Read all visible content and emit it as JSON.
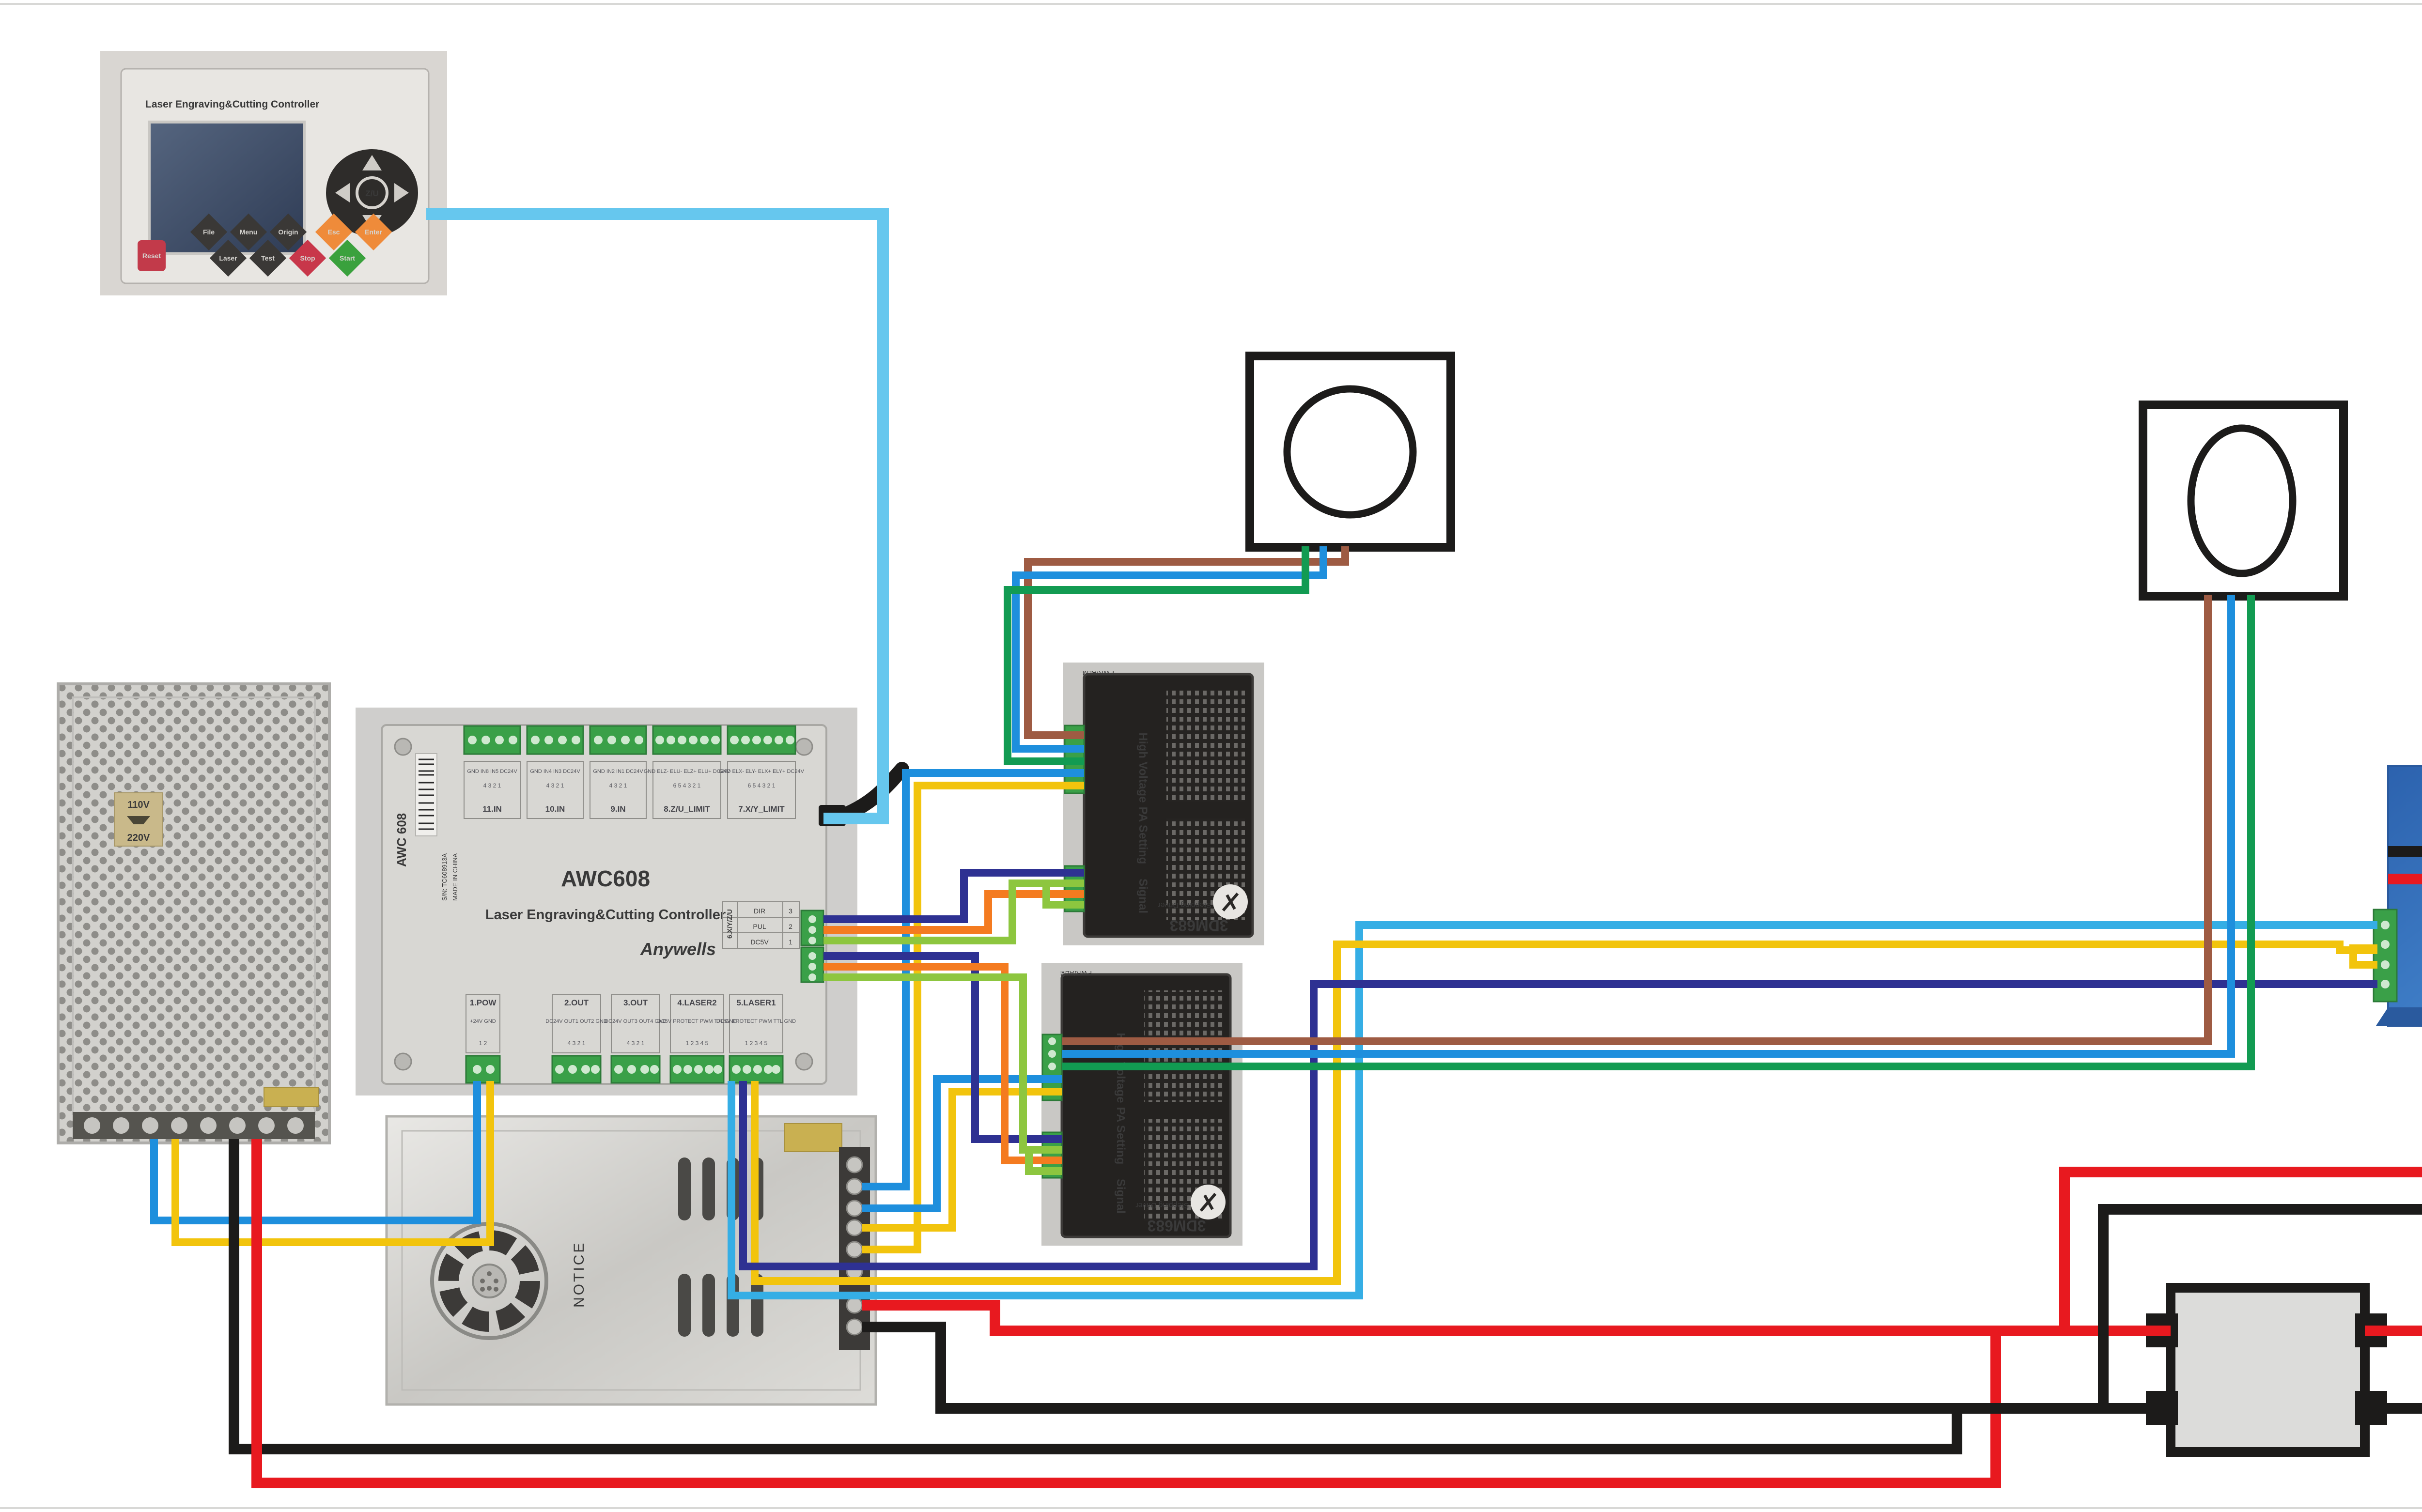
{
  "colors": {
    "lightblue": "#66c7ee",
    "blue": "#1e8fdd",
    "cyan": "#35aee5",
    "yellow": "#f2c40d",
    "navy": "#2e3192",
    "orange": "#f47b20",
    "lightgreen": "#8dc63f",
    "green": "#129b52",
    "brown": "#9e5b43",
    "red": "#e8191f",
    "black": "#1c1b1a",
    "btn_dark": "#3a3836",
    "btn_orange": "#ef8b3a",
    "btn_red": "#c8374a",
    "btn_green": "#3aa13d",
    "reset_red": "#c23a4a",
    "board_green": "#3aa048",
    "laser_blue": "#3f7ec7",
    "psu_silver": "#cfcecb"
  },
  "panel": {
    "title": "Laser Engraving&Cutting Controller",
    "reset": "Reset",
    "file": "File",
    "menu": "Menu",
    "origin": "Origin",
    "esc": "Esc",
    "enter": "Enter",
    "laser": "Laser",
    "test": "Test",
    "stop": "Stop",
    "start": "Start",
    "zu": "Z/U"
  },
  "awc": {
    "model": "AWC608",
    "subtitle": "Laser Engraving&Cutting Controller",
    "brand": "Anywells",
    "side_model": "AWC 608",
    "serial": "S/N: TC608913A",
    "made": "MADE IN CHINA",
    "block_11in": "11.IN",
    "block_10in": "10.IN",
    "block_9in": "9.IN",
    "block_zu_limit": "8.Z/U_LIMIT",
    "block_xy_limit": "7.X/Y_LIMIT",
    "pins_11in": "GND IN8 IN5 DC24V",
    "pins_10in": "GND IN4 IN3 DC24V",
    "pins_9in": "GND IN2 IN1 DC24V",
    "pins_zu": "GND ELZ- ELU- ELZ+ ELU+ DC24V",
    "pins_xy": "GND ELX- ELY- ELX+ ELY+ DC24V",
    "nums4": "4 3 2 1",
    "nums6": "6 5 4 3 2 1",
    "nums2": "1 2",
    "nums5": "1 2 3 4 5",
    "block_pow": "1.POW",
    "pins_pow": "+24V GND",
    "block_out2": "2.OUT",
    "pins_out2": "DC24V OUT1 OUT2 GND",
    "block_out3": "3.OUT",
    "pins_out3": "DC24V OUT3 OUT4 GND",
    "block_laser2": "4.LASER2",
    "block_laser1": "5.LASER1",
    "pins_laser": "DC5V PROTECT PWM TTL GND",
    "block_xyzu": "6.X/Y/Z/U",
    "dir": "DIR",
    "pul": "PUL",
    "dc5v": "DC5V",
    "n3": "3",
    "n2": "2",
    "n1": "1"
  },
  "driver": {
    "hv": "High Voltage",
    "pa": "PA Setting",
    "sig": "Signal",
    "model": "3DM683",
    "type": "Digital Stepping Driver",
    "pwr": "PWR/ALM"
  },
  "left_psu": {
    "v110": "110V",
    "v220": "220V"
  },
  "silver_psu": {
    "notice": "NOTICE"
  }
}
